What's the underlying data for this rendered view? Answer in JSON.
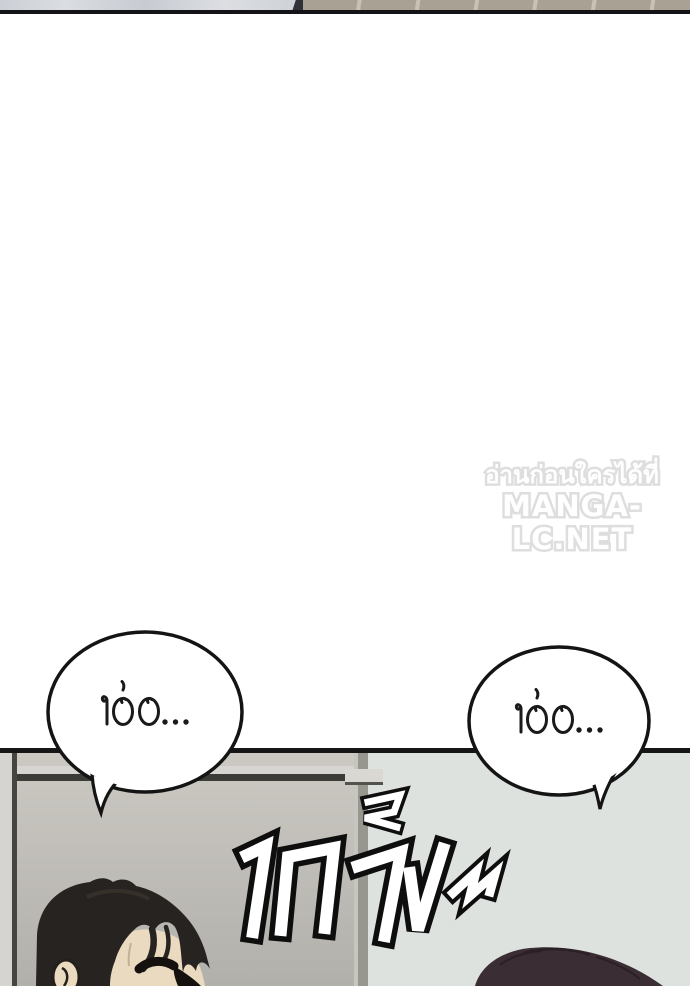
{
  "page": {
    "width_px": 690,
    "height_px": 986,
    "background": "#ffffff"
  },
  "top_panel_strip": {
    "wall_color": "#cdd1d7",
    "tile_color": "#a9a193",
    "grout_color": "#c9c2b3",
    "border_color": "#141418"
  },
  "watermark": {
    "line1": "อ่านก่อนใครได้ที่",
    "line2": "MANGA-LC.NET",
    "fill_color": "#ffffff",
    "outline_color": "#dedede"
  },
  "speech_bubbles": [
    {
      "position": "left",
      "text": "เอ่อ...",
      "fill": "#ffffff",
      "outline": "#141414"
    },
    {
      "position": "right",
      "text": "เอ่อ...",
      "fill": "#ffffff",
      "outline": "#141414"
    }
  ],
  "bottom_panel": {
    "border_color": "#161616",
    "left_room_color": "#c0bdb8",
    "right_room_color": "#dee2df",
    "divider_color": "#98978f",
    "wall_line_color": "#3b3b37",
    "sfx_text": "เกร็ง~",
    "sfx_fill": "#ffffff",
    "sfx_outline": "#0e0e0e",
    "characters": [
      {
        "position": "left",
        "hair_color": "#272320",
        "skin_color": "#eadabf"
      },
      {
        "position": "right",
        "hair_color": "#3a2d34"
      }
    ]
  }
}
